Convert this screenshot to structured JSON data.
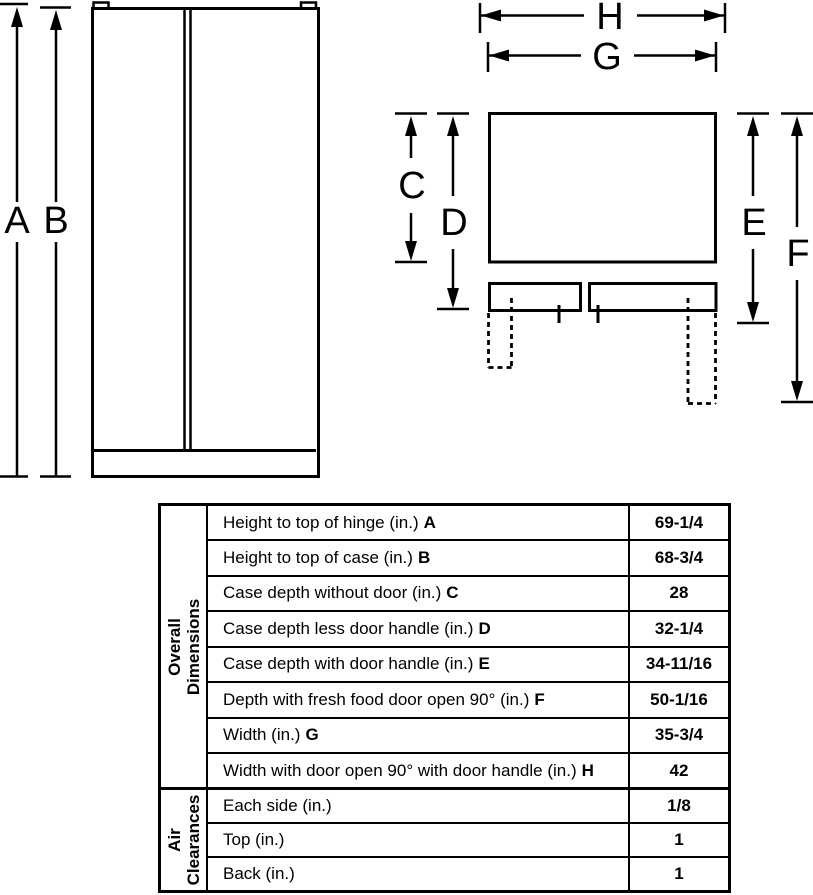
{
  "diagram": {
    "front_view": {
      "label_a": "A",
      "label_b": "B"
    },
    "top_view": {
      "label_c": "C",
      "label_d": "D",
      "label_e": "E",
      "label_f": "F",
      "label_g": "G",
      "label_h": "H"
    },
    "line_color": "#000000",
    "background": "#ffffff"
  },
  "table": {
    "sections": [
      {
        "category": {
          "line1": "Overall",
          "line2": "Dimensions"
        },
        "rows": [
          {
            "label": "Height to top of hinge (in.)",
            "letter": "A",
            "value": "69-1/4"
          },
          {
            "label": "Height to top of case (in.)",
            "letter": "B",
            "value": "68-3/4"
          },
          {
            "label": "Case depth without door (in.)",
            "letter": "C",
            "value": "28"
          },
          {
            "label": "Case depth less door handle (in.)",
            "letter": "D",
            "value": "32-1/4"
          },
          {
            "label": "Case depth with door handle (in.)",
            "letter": "E",
            "value": "34-11/16"
          },
          {
            "label": "Depth with fresh food door open 90° (in.)",
            "letter": "F",
            "value": "50-1/16"
          },
          {
            "label": "Width (in.)",
            "letter": "G",
            "value": "35-3/4"
          },
          {
            "label": "Width with door open 90° with door handle (in.)",
            "letter": "H",
            "value": "42"
          }
        ]
      },
      {
        "category": {
          "line1": "Air",
          "line2": "Clearances"
        },
        "rows": [
          {
            "label": "Each side (in.)",
            "letter": "",
            "value": "1/8"
          },
          {
            "label": "Top (in.)",
            "letter": "",
            "value": "1"
          },
          {
            "label": "Back (in.)",
            "letter": "",
            "value": "1"
          }
        ]
      }
    ]
  }
}
